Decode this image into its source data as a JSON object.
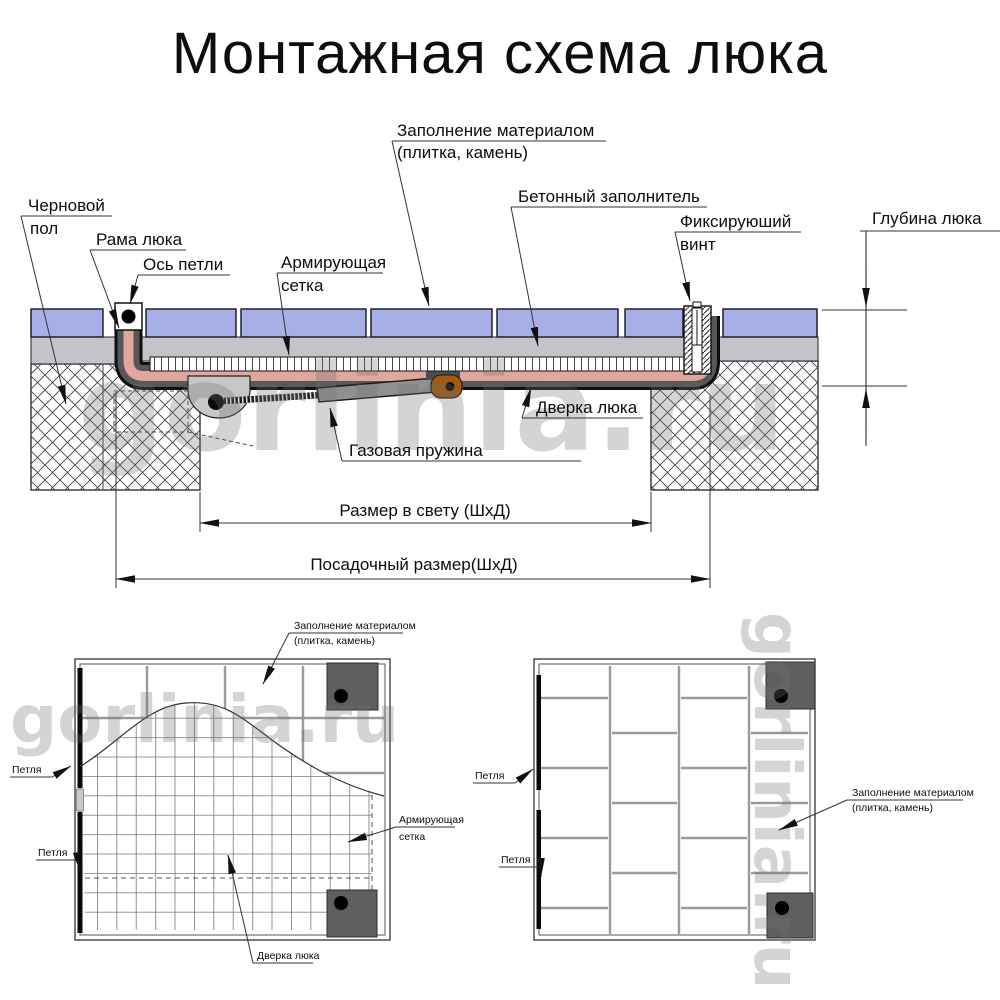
{
  "title": "Монтажная схема люка",
  "watermark": {
    "text": "gorlinia.ru"
  },
  "colors": {
    "tile_blue": "#a8afe6",
    "concrete_gray": "#c3c3ca",
    "frame_salmon": "#dfa79d",
    "profile_dark": "#575757",
    "bracket_orange": "#a3590f",
    "hinge_plate_gray": "#5f5f5f",
    "watermark_gray": "#6f6f6f"
  },
  "section": {
    "labels": {
      "fill_line1": "Заполнение материалом",
      "fill_line2": "(плитка, камень)",
      "concrete": "Бетонный заполнитель",
      "rough_floor_line1": "Черновой",
      "rough_floor_line2": "пол",
      "frame": "Рама люка",
      "hinge_axis": "Ось петли",
      "mesh_line1": "Армирующая",
      "mesh_line2": "сетка",
      "screw_line1": "Фиксируюший",
      "screw_line2": "винт",
      "depth": "Глубина люка",
      "door": "Дверка люка",
      "gas_spring": "Газовая пружина"
    },
    "dimensions": {
      "clear_size": "Размер в свету (ШхД)",
      "mounting_size": "Посадочный размер(ШхД)"
    }
  },
  "plan_left": {
    "labels": {
      "fill_line1": "Заполнение материалом",
      "fill_line2": "(плитка, камень)",
      "hinge_top": "Петля",
      "hinge_bottom": "Петля",
      "mesh_line1": "Армирующая",
      "mesh_line2": "сетка",
      "door": "Дверка люка"
    }
  },
  "plan_right": {
    "labels": {
      "hinge_top": "Петля",
      "hinge_bottom": "Петля",
      "fill_line1": "Заполнение материалом",
      "fill_line2": "(плитка, камень)"
    }
  }
}
